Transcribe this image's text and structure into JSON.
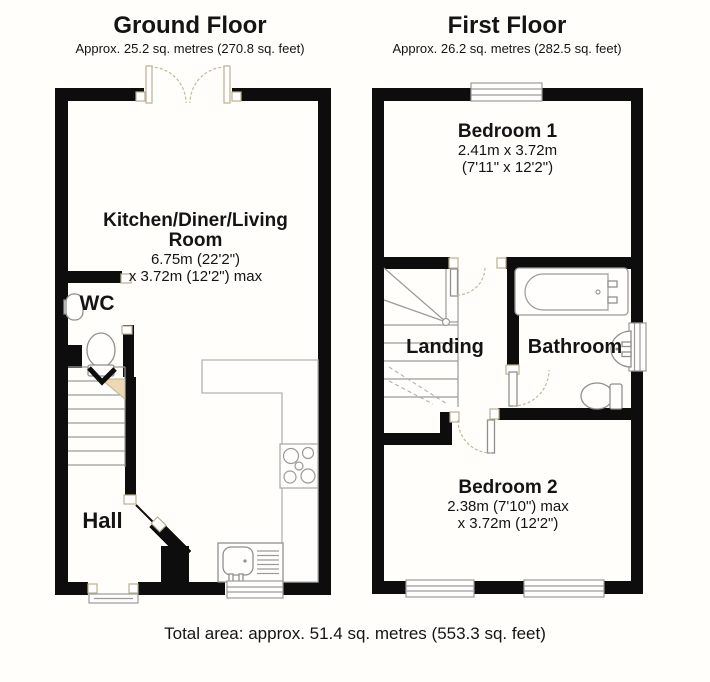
{
  "ground_floor": {
    "title": "Ground Floor",
    "subtitle": "Approx. 25.2 sq. metres (270.8 sq. feet)",
    "kitchen_name_1": "Kitchen/Diner/Living",
    "kitchen_name_2": "Room",
    "kitchen_dim_1": "6.75m (22'2\")",
    "kitchen_dim_2": "x 3.72m (12'2\") max",
    "wc": "WC",
    "hall": "Hall"
  },
  "first_floor": {
    "title": "First Floor",
    "subtitle": "Approx. 26.2 sq. metres (282.5 sq. feet)",
    "bedroom1_name": "Bedroom 1",
    "bedroom1_dim_1": "2.41m x 3.72m",
    "bedroom1_dim_2": "(7'11\" x 12'2\")",
    "landing": "Landing",
    "bathroom": "Bathroom",
    "bedroom2_name": "Bedroom 2",
    "bedroom2_dim_1": "2.38m (7'10\") max",
    "bedroom2_dim_2": "x 3.72m (12'2\")"
  },
  "footer": {
    "total_area": "Total area: approx. 51.4 sq. metres (553.3 sq. feet)"
  },
  "colors": {
    "wall": "#0d0d0d",
    "background": "#fffefb",
    "accent_beige": "#ead9b4"
  }
}
